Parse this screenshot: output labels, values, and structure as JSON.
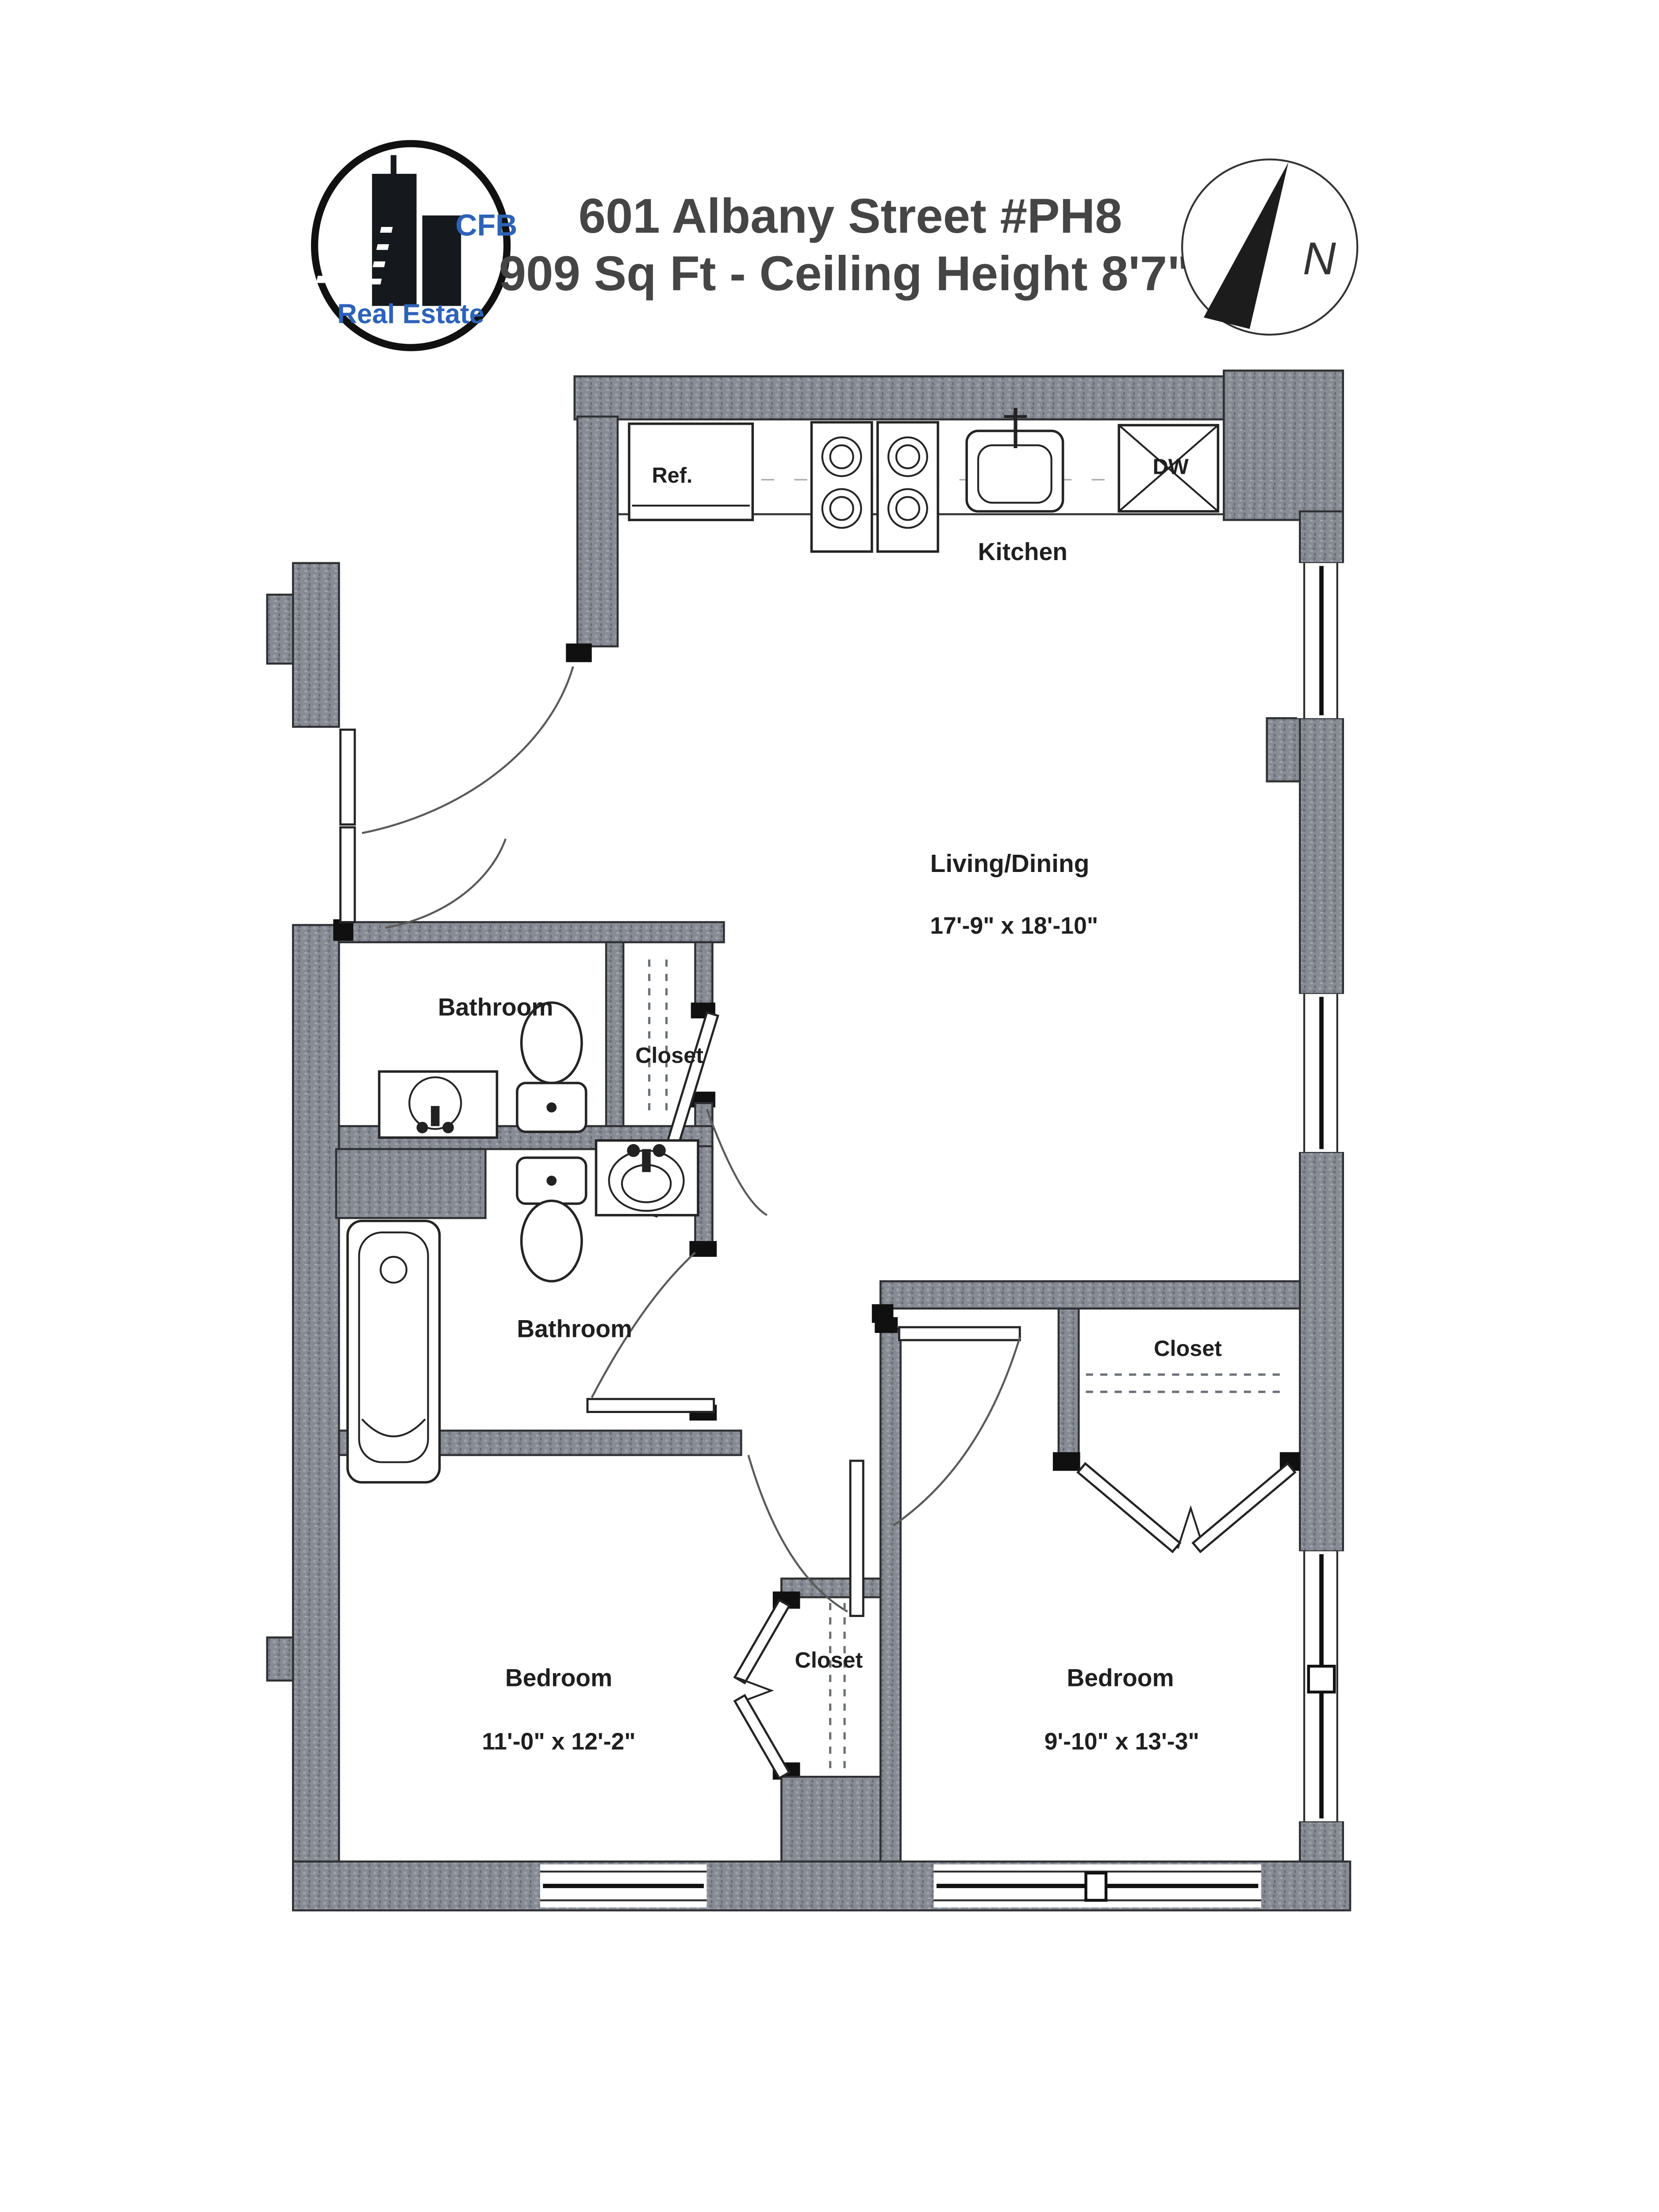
{
  "header": {
    "address": "601 Albany Street #PH8",
    "details": "909 Sq Ft - Ceiling Height 8'7\""
  },
  "logo": {
    "top": "CFB",
    "bottom": "Real Estate",
    "accent_color": "#2d62b8",
    "ring_color": "#111111"
  },
  "compass": {
    "label": "N"
  },
  "colors": {
    "wall": "#878b93",
    "line": "#222222",
    "label": "#1f1f1f",
    "title": "#454545"
  },
  "rooms": {
    "kitchen": {
      "name": "Kitchen"
    },
    "living": {
      "name": "Living/Dining",
      "dims": "17'-9\" x 18'-10\""
    },
    "bathroom1": {
      "name": "Bathroom"
    },
    "closet_hall": {
      "name": "Closet"
    },
    "bathroom2": {
      "name": "Bathroom"
    },
    "closet_bedroom2": {
      "name": "Closet"
    },
    "bedroom1": {
      "name": "Bedroom",
      "dims": "11'-0\" x 12'-2\""
    },
    "closet_bedroom1": {
      "name": "Closet"
    },
    "bedroom2": {
      "name": "Bedroom",
      "dims": "9'-10\" x 13'-3\""
    }
  },
  "fixtures": {
    "refrigerator": "Ref.",
    "dishwasher": "DW"
  }
}
